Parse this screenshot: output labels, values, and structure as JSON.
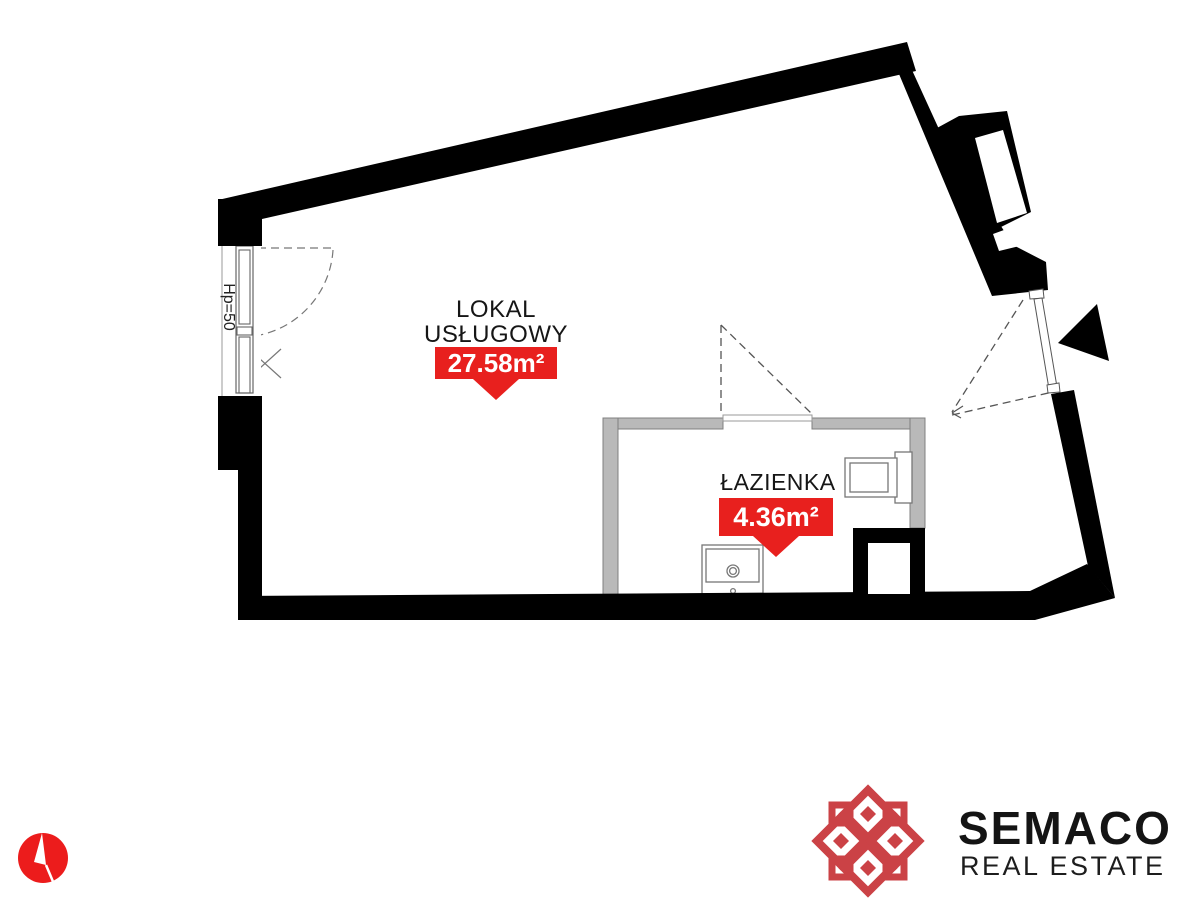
{
  "plan": {
    "main_room": {
      "name_line1": "LOKAL",
      "name_line2": "USŁUGOWY",
      "area": "27.58m²"
    },
    "bathroom": {
      "name": "ŁAZIENKA",
      "area": "4.36m²"
    },
    "window_label": "Hp=50"
  },
  "branding": {
    "company": "SEMACO",
    "tagline": "REAL ESTATE"
  },
  "icons": {
    "north_compass": "north-compass-icon",
    "entrance_arrow": "entrance-arrow-icon",
    "logo_knot": "logo-knot-icon"
  },
  "colors": {
    "badge_red": "#e8201e",
    "logo_red": "#cb4246",
    "compass_red": "#ec1c1c",
    "wall_black": "#000000",
    "partition_gray": "#b9b9b9"
  }
}
